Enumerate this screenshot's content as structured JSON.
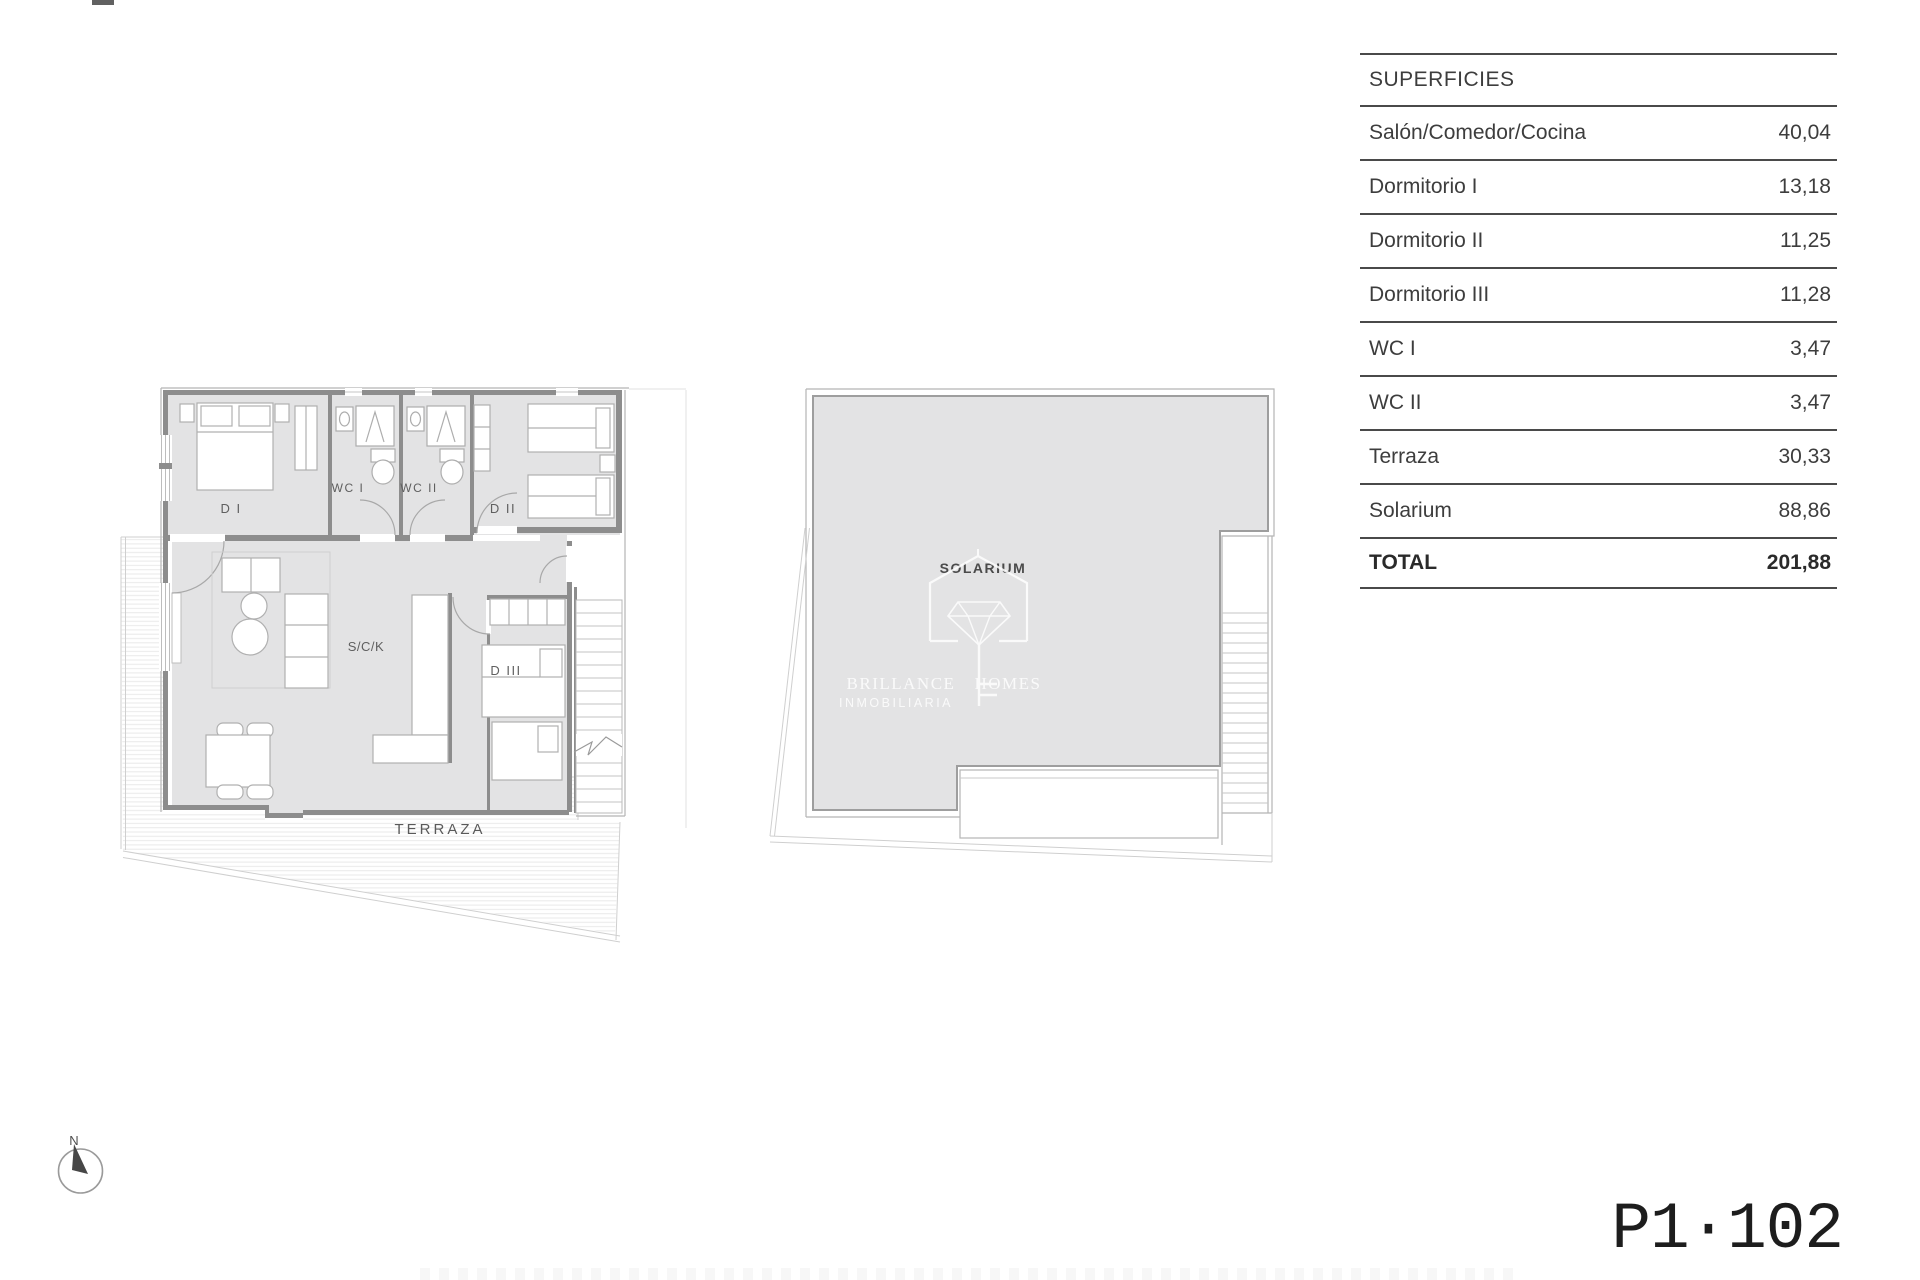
{
  "surfaces_table": {
    "title": "SUPERFICIES",
    "rows": [
      {
        "label": "Salón/Comedor/Cocina",
        "value": "40,04"
      },
      {
        "label": "Dormitorio I",
        "value": "13,18"
      },
      {
        "label": "Dormitorio II",
        "value": "11,25"
      },
      {
        "label": "Dormitorio III",
        "value": "11,28"
      },
      {
        "label": "WC I",
        "value": "3,47"
      },
      {
        "label": "WC II",
        "value": "3,47"
      },
      {
        "label": "Terraza",
        "value": "30,33"
      },
      {
        "label": "Solarium",
        "value": "88,86"
      }
    ],
    "total_row": {
      "label": "TOTAL",
      "value": "201,88"
    }
  },
  "apartment_plan": {
    "rooms": {
      "d1": "D I",
      "wc1": "WC I",
      "wc2": "WC II",
      "d2": "D II",
      "sck": "S/C/K",
      "d3": "D III",
      "terrace": "TERRAZA"
    }
  },
  "solarium_plan": {
    "room_label": "SOLARIUM"
  },
  "watermark": {
    "brand_word1": "BRILLANCE",
    "brand_word2": "HOMES",
    "subtitle": "INMOBILIARIA"
  },
  "compass": {
    "north_label": "N"
  },
  "unit_code": "P1·102",
  "colors": {
    "plan_fill": "#e3e3e4",
    "wall_dark": "#8d8d8d",
    "line_light": "#b5b5b5",
    "hatch_line": "#e9e9e9",
    "table_line": "#4a4a4a",
    "table_text": "#3d3d3d",
    "label_text": "#5f5f5f",
    "code_text": "#1d1d1d"
  }
}
